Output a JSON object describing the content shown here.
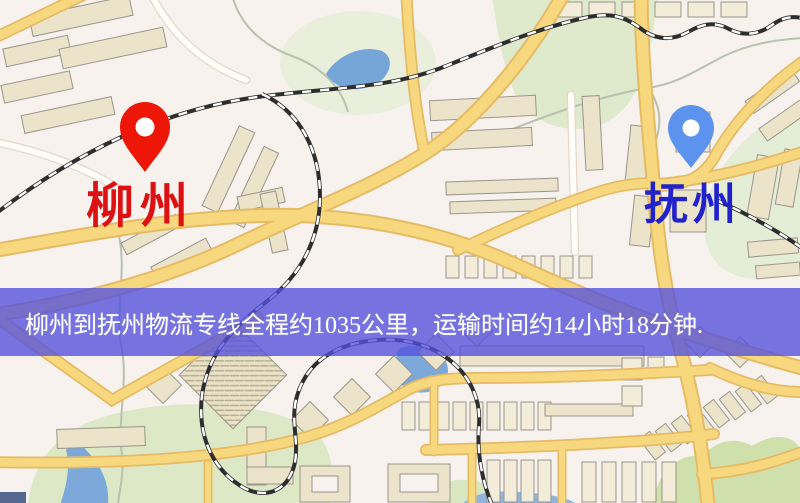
{
  "banner": {
    "text": "柳州到抚州物流专线全程约1035公里，运输时间约14小时18分钟.",
    "bg_color": "#5250de",
    "text_color": "#ffffff"
  },
  "origin": {
    "label": "柳州",
    "pin_color": "#ee1606",
    "label_color": "#dd1111"
  },
  "destination": {
    "label": "抚州",
    "pin_color": "#5b93ee",
    "label_color": "#2222cc"
  },
  "route": {
    "distance_km": "1035",
    "duration": "14小时18分钟"
  },
  "map_palette": {
    "background": "#f7f2ee",
    "road_major": "#f8d87e",
    "road_casing": "#e6bb66",
    "road_minor": "#fffdf8",
    "water": "#76a5d7",
    "park": "#dfe9cb",
    "building": "#ebe4ca",
    "railway": "#2e2e2e"
  }
}
